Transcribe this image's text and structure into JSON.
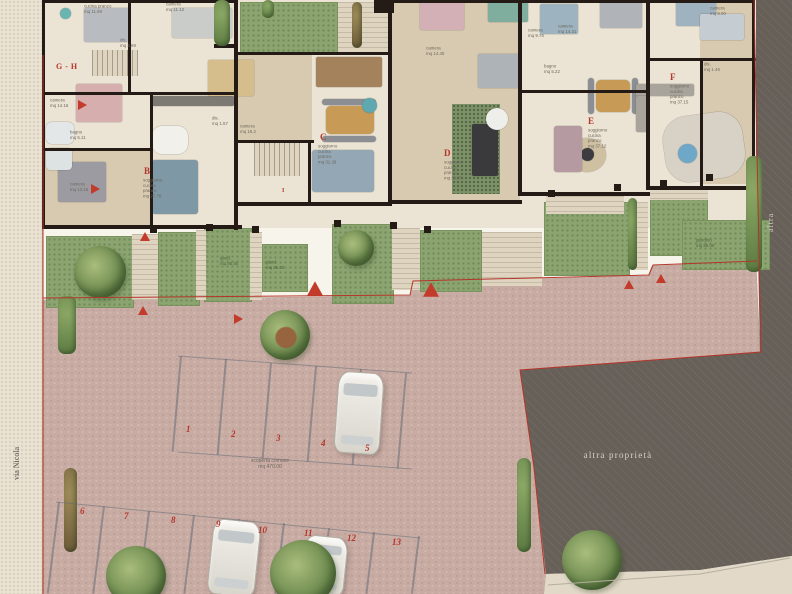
{
  "colors": {
    "accent_red": "#b5362b",
    "wall_dark": "#241a16",
    "paving_mauve": "#c8aca4",
    "garden_green": "#8ba470",
    "other_property_gray": "#676059",
    "street_beige": "#e9e1d1"
  },
  "labels": {
    "street": "via Nicola",
    "right_edge": "altra",
    "other_property": "altra proprietà",
    "courtyard_line1": "scoperta comune",
    "courtyard_line2": "mq 470.00"
  },
  "apartment_labels": [
    {
      "t": "G - H",
      "x": 56,
      "y": 62,
      "s": 8
    },
    {
      "t": "B",
      "x": 144,
      "y": 166,
      "s": 9
    },
    {
      "t": "C",
      "x": 320,
      "y": 132,
      "s": 9
    },
    {
      "t": "D",
      "x": 444,
      "y": 148,
      "s": 9
    },
    {
      "t": "E",
      "x": 588,
      "y": 116,
      "s": 9
    },
    {
      "t": "F",
      "x": 670,
      "y": 72,
      "s": 9
    },
    {
      "t": "I",
      "x": 282,
      "y": 188,
      "s": 6
    }
  ],
  "room_labels": [
    {
      "x": 84,
      "y": 4,
      "lines": [
        "cucina pranzo",
        "mq 11.90"
      ]
    },
    {
      "x": 120,
      "y": 38,
      "lines": [
        "dis.",
        "mq 3.69"
      ]
    },
    {
      "x": 166,
      "y": 2,
      "lines": [
        "camera",
        "mq 11.12"
      ]
    },
    {
      "x": 50,
      "y": 98,
      "lines": [
        "camera",
        "mq 14.16"
      ]
    },
    {
      "x": 70,
      "y": 130,
      "lines": [
        "bagno",
        "mq 5.11"
      ]
    },
    {
      "x": 70,
      "y": 182,
      "lines": [
        "camera",
        "mq 13.16"
      ]
    },
    {
      "x": 143,
      "y": 178,
      "lines": [
        "soggiorno",
        "cucina",
        "pranzo",
        "mq 27.78"
      ]
    },
    {
      "x": 240,
      "y": 124,
      "lines": [
        "camera",
        "mq 16.2"
      ]
    },
    {
      "x": 212,
      "y": 116,
      "lines": [
        "dis.",
        "mq 1.57"
      ]
    },
    {
      "x": 318,
      "y": 144,
      "lines": [
        "soggiorno",
        "cucina",
        "pranzo",
        "mq 31.28"
      ]
    },
    {
      "x": 426,
      "y": 46,
      "lines": [
        "camera",
        "mq 14.40"
      ]
    },
    {
      "x": 444,
      "y": 160,
      "lines": [
        "soggiorno",
        "cucina",
        "pranzo",
        "mq 36.70"
      ]
    },
    {
      "x": 588,
      "y": 128,
      "lines": [
        "soggiorno",
        "cucina",
        "pranzo",
        "mq 37.12"
      ]
    },
    {
      "x": 670,
      "y": 84,
      "lines": [
        "soggiorno",
        "cucina",
        "pranzo",
        "mq 37.15"
      ]
    },
    {
      "x": 704,
      "y": 62,
      "lines": [
        "dis.",
        "mq 1.46"
      ]
    },
    {
      "x": 558,
      "y": 24,
      "lines": [
        "camera",
        "mq 14.31"
      ]
    },
    {
      "x": 528,
      "y": 28,
      "lines": [
        "camera",
        "mq 9.76"
      ]
    },
    {
      "x": 544,
      "y": 64,
      "lines": [
        "bagno",
        "mq 5.22"
      ]
    },
    {
      "x": 710,
      "y": 6,
      "lines": [
        "camera",
        "mq 9.00"
      ]
    }
  ],
  "garden_labels": [
    {
      "x": 220,
      "y": 256,
      "lines": [
        "giard.",
        "mq 95.00"
      ]
    },
    {
      "x": 266,
      "y": 260,
      "lines": [
        "giard.",
        "mq 85.00"
      ]
    },
    {
      "x": 696,
      "y": 238,
      "lines": [
        "giardino",
        "mq 85.00"
      ]
    }
  ],
  "parking_numbers": [
    {
      "t": "1",
      "x": 186,
      "y": 424
    },
    {
      "t": "2",
      "x": 231,
      "y": 429
    },
    {
      "t": "3",
      "x": 276,
      "y": 433
    },
    {
      "t": "4",
      "x": 321,
      "y": 438
    },
    {
      "t": "5",
      "x": 365,
      "y": 443
    },
    {
      "t": "6",
      "x": 80,
      "y": 506
    },
    {
      "t": "7",
      "x": 124,
      "y": 511
    },
    {
      "t": "8",
      "x": 171,
      "y": 515
    },
    {
      "t": "9",
      "x": 216,
      "y": 519
    },
    {
      "t": "10",
      "x": 258,
      "y": 525
    },
    {
      "t": "11",
      "x": 304,
      "y": 528
    },
    {
      "t": "12",
      "x": 347,
      "y": 533
    },
    {
      "t": "13",
      "x": 392,
      "y": 537
    }
  ],
  "triangles": [
    {
      "x": 78,
      "y": 100,
      "d": "right"
    },
    {
      "x": 91,
      "y": 184,
      "d": "right"
    },
    {
      "x": 140,
      "y": 232,
      "d": "up"
    },
    {
      "x": 138,
      "y": 306,
      "d": "up"
    },
    {
      "x": 234,
      "y": 314,
      "d": "right"
    },
    {
      "x": 310,
      "y": 284,
      "d": "up",
      "big": true
    },
    {
      "x": 426,
      "y": 285,
      "d": "up",
      "big": true
    },
    {
      "x": 624,
      "y": 280,
      "d": "up"
    },
    {
      "x": 656,
      "y": 274,
      "d": "up"
    }
  ],
  "floors": [
    {
      "x": 42,
      "y": 0,
      "w": 714,
      "h": 228,
      "cls": "floor"
    },
    {
      "x": 390,
      "y": 0,
      "w": 130,
      "h": 202,
      "cls": "wood"
    },
    {
      "x": 238,
      "y": 55,
      "w": 74,
      "h": 86,
      "cls": "wood"
    },
    {
      "x": 42,
      "y": 150,
      "w": 110,
      "h": 76,
      "cls": "wood"
    },
    {
      "x": 700,
      "y": 2,
      "w": 54,
      "h": 182,
      "cls": "wood"
    },
    {
      "x": 452,
      "y": 104,
      "w": 48,
      "h": 90,
      "cls": "plants"
    }
  ],
  "gardens": [
    {
      "x": 46,
      "y": 236,
      "w": 86,
      "h": 70
    },
    {
      "x": 158,
      "y": 232,
      "w": 40,
      "h": 72
    },
    {
      "x": 204,
      "y": 228,
      "w": 46,
      "h": 72
    },
    {
      "x": 262,
      "y": 244,
      "w": 44,
      "h": 46
    },
    {
      "x": 332,
      "y": 224,
      "w": 60,
      "h": 78
    },
    {
      "x": 420,
      "y": 230,
      "w": 60,
      "h": 60
    },
    {
      "x": 544,
      "y": 202,
      "w": 84,
      "h": 72
    },
    {
      "x": 650,
      "y": 196,
      "w": 56,
      "h": 58
    },
    {
      "x": 682,
      "y": 220,
      "w": 86,
      "h": 48
    },
    {
      "x": 240,
      "y": 2,
      "w": 96,
      "h": 50
    }
  ],
  "steps": [
    {
      "x": 132,
      "y": 234,
      "w": 26,
      "h": 66
    },
    {
      "x": 196,
      "y": 230,
      "w": 10,
      "h": 70
    },
    {
      "x": 250,
      "y": 232,
      "w": 12,
      "h": 68
    },
    {
      "x": 392,
      "y": 228,
      "w": 28,
      "h": 62
    },
    {
      "x": 482,
      "y": 232,
      "w": 60,
      "h": 54
    },
    {
      "x": 632,
      "y": 202,
      "w": 16,
      "h": 68
    },
    {
      "x": 546,
      "y": 196,
      "w": 78,
      "h": 18
    },
    {
      "x": 650,
      "y": 188,
      "w": 58,
      "h": 12
    },
    {
      "x": 338,
      "y": 2,
      "w": 50,
      "h": 50
    },
    {
      "x": 254,
      "y": 142,
      "w": 46,
      "h": 34,
      "v": 1
    },
    {
      "x": 92,
      "y": 50,
      "w": 46,
      "h": 26,
      "v": 1
    }
  ],
  "walls": [
    {
      "x": 42,
      "y": 0,
      "w": 196,
      "h": 3
    },
    {
      "x": 388,
      "y": 0,
      "w": 366,
      "h": 3
    },
    {
      "x": 42,
      "y": 0,
      "w": 3,
      "h": 228
    },
    {
      "x": 42,
      "y": 225,
      "w": 200,
      "h": 4
    },
    {
      "x": 238,
      "y": 202,
      "w": 154,
      "h": 4
    },
    {
      "x": 390,
      "y": 200,
      "w": 132,
      "h": 4
    },
    {
      "x": 520,
      "y": 192,
      "w": 130,
      "h": 4
    },
    {
      "x": 648,
      "y": 186,
      "w": 108,
      "h": 4
    },
    {
      "x": 128,
      "y": 0,
      "w": 3,
      "h": 94
    },
    {
      "x": 234,
      "y": 0,
      "w": 4,
      "h": 230
    },
    {
      "x": 42,
      "y": 92,
      "w": 196,
      "h": 3
    },
    {
      "x": 150,
      "y": 92,
      "w": 3,
      "h": 136
    },
    {
      "x": 42,
      "y": 148,
      "w": 110,
      "h": 3
    },
    {
      "x": 388,
      "y": 0,
      "w": 4,
      "h": 204
    },
    {
      "x": 236,
      "y": 140,
      "w": 78,
      "h": 3
    },
    {
      "x": 308,
      "y": 140,
      "w": 3,
      "h": 65
    },
    {
      "x": 236,
      "y": 52,
      "w": 156,
      "h": 3
    },
    {
      "x": 518,
      "y": 0,
      "w": 4,
      "h": 196
    },
    {
      "x": 520,
      "y": 90,
      "w": 130,
      "h": 3
    },
    {
      "x": 646,
      "y": 0,
      "w": 4,
      "h": 190
    },
    {
      "x": 648,
      "y": 58,
      "w": 108,
      "h": 3
    },
    {
      "x": 700,
      "y": 60,
      "w": 3,
      "h": 126
    },
    {
      "x": 752,
      "y": 0,
      "w": 3,
      "h": 186
    },
    {
      "x": 374,
      "y": 0,
      "w": 20,
      "h": 13
    },
    {
      "x": 214,
      "y": 44,
      "w": 20,
      "h": 4
    },
    {
      "x": 150,
      "y": 226,
      "w": 7,
      "h": 7
    },
    {
      "x": 206,
      "y": 224,
      "w": 7,
      "h": 7
    },
    {
      "x": 252,
      "y": 226,
      "w": 7,
      "h": 7
    },
    {
      "x": 334,
      "y": 220,
      "w": 7,
      "h": 7
    },
    {
      "x": 390,
      "y": 222,
      "w": 7,
      "h": 7
    },
    {
      "x": 424,
      "y": 226,
      "w": 7,
      "h": 7
    },
    {
      "x": 548,
      "y": 190,
      "w": 7,
      "h": 7
    },
    {
      "x": 614,
      "y": 184,
      "w": 7,
      "h": 7
    },
    {
      "x": 660,
      "y": 180,
      "w": 7,
      "h": 7
    },
    {
      "x": 706,
      "y": 174,
      "w": 7,
      "h": 7
    }
  ],
  "furniture": [
    {
      "n": "bed",
      "x": 84,
      "y": 8,
      "w": 46,
      "h": 34,
      "c": "#b8bcc0"
    },
    {
      "n": "side-table",
      "x": 60,
      "y": 8,
      "w": 11,
      "h": 11,
      "c": "#6ab4b2",
      "cir": 1
    },
    {
      "n": "bed-pink",
      "x": 76,
      "y": 84,
      "w": 46,
      "h": 38,
      "c": "#d7aeae"
    },
    {
      "n": "bed-gray",
      "x": 58,
      "y": 162,
      "w": 48,
      "h": 40,
      "c": "#9b9ba1"
    },
    {
      "n": "wardrobe",
      "x": 172,
      "y": 8,
      "w": 60,
      "h": 30,
      "c": "#c9ccc8"
    },
    {
      "n": "kitchen-counter",
      "x": 152,
      "y": 96,
      "w": 82,
      "h": 10,
      "c": "#7d7a74"
    },
    {
      "n": "dining-table",
      "x": 152,
      "y": 126,
      "w": 36,
      "h": 28,
      "c": "#f2f0ea",
      "r": 10
    },
    {
      "n": "sofa-blue",
      "x": 152,
      "y": 160,
      "w": 46,
      "h": 54,
      "c": "#7e98a6",
      "r": 3
    },
    {
      "n": "bed-tan",
      "x": 208,
      "y": 60,
      "w": 46,
      "h": 36,
      "c": "#d6bd8c"
    },
    {
      "n": "kitchen-wood",
      "x": 316,
      "y": 57,
      "w": 66,
      "h": 30,
      "c": "#a3825c"
    },
    {
      "n": "dining-table-wood",
      "x": 326,
      "y": 106,
      "w": 48,
      "h": 28,
      "c": "#c79a55",
      "r": 5
    },
    {
      "n": "chairs",
      "x": 322,
      "y": 99,
      "w": 54,
      "h": 6,
      "c": "#8b8f93",
      "r": 3
    },
    {
      "n": "chairs",
      "x": 322,
      "y": 136,
      "w": 54,
      "h": 6,
      "c": "#8b8f93",
      "r": 3
    },
    {
      "n": "rug-round",
      "x": 362,
      "y": 98,
      "w": 15,
      "h": 15,
      "c": "#5fa8b0",
      "cir": 1
    },
    {
      "n": "sofa",
      "x": 312,
      "y": 150,
      "w": 62,
      "h": 42,
      "c": "#93a7b4",
      "r": 3
    },
    {
      "n": "bed",
      "x": 478,
      "y": 54,
      "w": 42,
      "h": 34,
      "c": "#aeb3b8"
    },
    {
      "n": "bed-pink",
      "x": 420,
      "y": 0,
      "w": 44,
      "h": 30,
      "c": "#d3b0b5"
    },
    {
      "n": "bed-teal",
      "x": 488,
      "y": 0,
      "w": 40,
      "h": 22,
      "c": "#7fae9f"
    },
    {
      "n": "kitchen-island",
      "x": 472,
      "y": 124,
      "w": 26,
      "h": 52,
      "c": "#3a3a3c",
      "r": 2
    },
    {
      "n": "table-round",
      "x": 486,
      "y": 108,
      "w": 22,
      "h": 22,
      "c": "#eeeeea",
      "cir": 1
    },
    {
      "n": "bed",
      "x": 540,
      "y": 4,
      "w": 38,
      "h": 30,
      "c": "#9db3c0"
    },
    {
      "n": "bed",
      "x": 600,
      "y": 0,
      "w": 42,
      "h": 28,
      "c": "#b0b4b8"
    },
    {
      "n": "bed",
      "x": 676,
      "y": 0,
      "w": 40,
      "h": 26,
      "c": "#9fb2bf"
    },
    {
      "n": "wardrobe",
      "x": 700,
      "y": 14,
      "w": 44,
      "h": 26,
      "c": "#c6cdd2"
    },
    {
      "n": "dining-table-wood",
      "x": 596,
      "y": 80,
      "w": 34,
      "h": 32,
      "c": "#c79a55",
      "r": 5
    },
    {
      "n": "chairs",
      "x": 588,
      "y": 78,
      "w": 6,
      "h": 36,
      "c": "#8b8f93",
      "r": 3
    },
    {
      "n": "chairs",
      "x": 632,
      "y": 78,
      "w": 6,
      "h": 36,
      "c": "#8b8f93",
      "r": 3
    },
    {
      "n": "rug-round",
      "x": 568,
      "y": 138,
      "w": 38,
      "h": 34,
      "c": "#cfc0a2",
      "cir": 1
    },
    {
      "n": "coffee-table",
      "x": 581,
      "y": 148,
      "w": 13,
      "h": 13,
      "c": "#3c3c40",
      "cir": 1
    },
    {
      "n": "sofa-mauve",
      "x": 554,
      "y": 126,
      "w": 28,
      "h": 46,
      "c": "#b59aa2",
      "r": 3
    },
    {
      "n": "kitchen-counter",
      "x": 636,
      "y": 84,
      "w": 58,
      "h": 12,
      "c": "#a8a49c"
    },
    {
      "n": "kitchen-counter",
      "x": 636,
      "y": 96,
      "w": 12,
      "h": 36,
      "c": "#a8a49c"
    },
    {
      "n": "terrazzo-inlay",
      "x": 664,
      "y": 114,
      "w": 80,
      "h": 66,
      "c": "#d8d2c6",
      "r": 24,
      "rot": -8
    },
    {
      "n": "pool-spa",
      "x": 678,
      "y": 144,
      "w": 19,
      "h": 19,
      "c": "#6fa7c8",
      "cir": 1
    },
    {
      "n": "bathtub",
      "x": 46,
      "y": 122,
      "w": 28,
      "h": 22,
      "c": "#e3e7e7",
      "r": 6
    },
    {
      "n": "shower",
      "x": 46,
      "y": 148,
      "w": 26,
      "h": 22,
      "c": "#dde2e2",
      "r": 4
    }
  ],
  "trees": [
    {
      "x": 74,
      "y": 246,
      "r": 26
    },
    {
      "x": 338,
      "y": 230,
      "r": 18
    },
    {
      "x": 260,
      "y": 310,
      "r": 25,
      "warm": 1
    },
    {
      "x": 106,
      "y": 546,
      "r": 30
    },
    {
      "x": 270,
      "y": 540,
      "r": 33
    },
    {
      "x": 562,
      "y": 530,
      "r": 30
    }
  ],
  "hedges": [
    {
      "x": 214,
      "y": 0,
      "w": 16,
      "h": 46
    },
    {
      "x": 262,
      "y": 0,
      "w": 12,
      "h": 18
    },
    {
      "x": 352,
      "y": 2,
      "w": 10,
      "h": 46,
      "brown": 1
    },
    {
      "x": 517,
      "y": 458,
      "w": 14,
      "h": 94
    },
    {
      "x": 58,
      "y": 296,
      "w": 18,
      "h": 58
    },
    {
      "x": 64,
      "y": 468,
      "w": 13,
      "h": 84,
      "brown": 1
    },
    {
      "x": 628,
      "y": 198,
      "w": 9,
      "h": 72
    },
    {
      "x": 746,
      "y": 156,
      "w": 16,
      "h": 116
    }
  ],
  "stalls": [
    {
      "x": 180,
      "y": 356,
      "h": 96,
      "rot": 5
    },
    {
      "x": 225,
      "y": 359,
      "h": 96,
      "rot": 5
    },
    {
      "x": 270,
      "y": 363,
      "h": 96,
      "rot": 5
    },
    {
      "x": 315,
      "y": 366,
      "h": 96,
      "rot": 5
    },
    {
      "x": 360,
      "y": 369,
      "h": 96,
      "rot": 5
    },
    {
      "x": 405,
      "y": 373,
      "h": 96,
      "rot": 5
    },
    {
      "x": 58,
      "y": 502,
      "h": 92,
      "rot": 7
    },
    {
      "x": 103,
      "y": 506,
      "h": 88,
      "rot": 7
    },
    {
      "x": 148,
      "y": 511,
      "h": 83,
      "rot": 7
    },
    {
      "x": 193,
      "y": 515,
      "h": 79,
      "rot": 7
    },
    {
      "x": 238,
      "y": 519,
      "h": 75,
      "rot": 7
    },
    {
      "x": 283,
      "y": 523,
      "h": 71,
      "rot": 7
    },
    {
      "x": 328,
      "y": 528,
      "h": 66,
      "rot": 7
    },
    {
      "x": 373,
      "y": 532,
      "h": 62,
      "rot": 7
    },
    {
      "x": 418,
      "y": 536,
      "h": 58,
      "rot": 7
    }
  ],
  "cars": [
    {
      "x": 336,
      "y": 372,
      "w": 44,
      "h": 80,
      "rot": 4
    },
    {
      "x": 210,
      "y": 520,
      "w": 46,
      "h": 74,
      "rot": 6
    },
    {
      "x": 302,
      "y": 536,
      "w": 42,
      "h": 58,
      "rot": 6
    }
  ]
}
